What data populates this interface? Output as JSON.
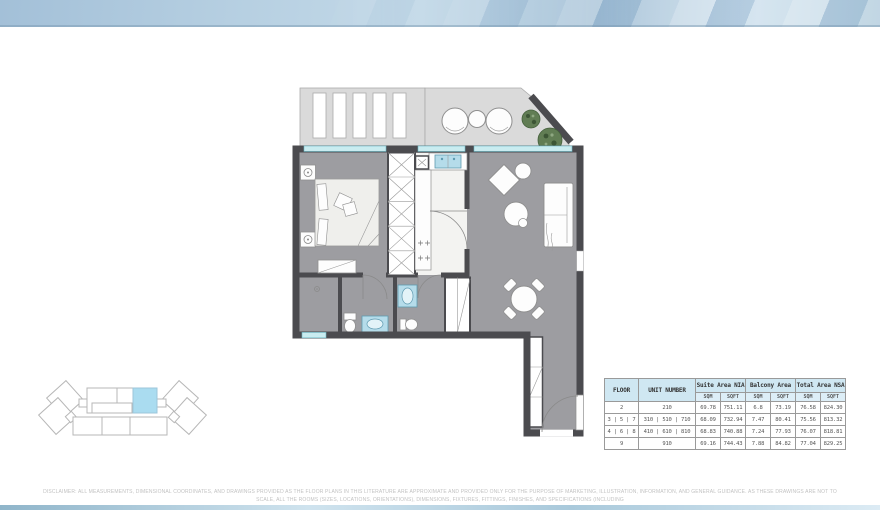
{
  "colors": {
    "wall": "#4b4b4f",
    "floor": "#9d9da1",
    "kitchen_floor": "#f3f3f1",
    "terrace": "#dadada",
    "window": "#c9ecf0",
    "window_edge": "#6ebac6",
    "fixture": "#b5dcea",
    "furniture": "#fdfdfd",
    "outline": "#8f8f8f",
    "plant": "#617d54",
    "table_header_bg": "#cfe7f2",
    "table_subheader_bg": "#ddeef7",
    "table_border": "#9a9a9a",
    "keyplan_line": "#b7b7b7",
    "keyplan_highlight": "#aadcf0"
  },
  "table": {
    "headers": {
      "floor": "FLOOR",
      "unit": "UNIT NUMBER",
      "suite": "Suite Area NIA",
      "balcony": "Balcony Area",
      "total": "Total Area NSA",
      "sqm": "SQM",
      "sqft": "SQFT"
    },
    "rows": [
      {
        "floor": "2",
        "unit": "210",
        "suite_sqm": "69.78",
        "suite_sqft": "751.11",
        "balcony_sqm": "6.8",
        "balcony_sqft": "73.19",
        "total_sqm": "76.58",
        "total_sqft": "824.30"
      },
      {
        "floor": "3 | 5 | 7",
        "unit": "310 | 510 | 710",
        "suite_sqm": "68.09",
        "suite_sqft": "732.94",
        "balcony_sqm": "7.47",
        "balcony_sqft": "80.41",
        "total_sqm": "75.56",
        "total_sqft": "813.32"
      },
      {
        "floor": "4 | 6 | 8",
        "unit": "410 | 610 | 810",
        "suite_sqm": "68.83",
        "suite_sqft": "740.88",
        "balcony_sqm": "7.24",
        "balcony_sqft": "77.93",
        "total_sqm": "76.07",
        "total_sqft": "818.81"
      },
      {
        "floor": "9",
        "unit": "910",
        "suite_sqm": "69.16",
        "suite_sqft": "744.43",
        "balcony_sqm": "7.88",
        "balcony_sqft": "84.82",
        "total_sqm": "77.04",
        "total_sqft": "829.25"
      }
    ]
  },
  "disclaimer": {
    "line1": "DISCLAIMER: ALL MEASUREMENTS, DIMENSIONAL COORDINATES, AND DRAWINGS PROVIDED AS THE FLOOR PLANS IN THIS LITERATURE ARE APPROXIMATE AND PROVIDED ONLY FOR THE PURPOSE OF MARKETING, ILLUSTRATION, INFORMATION, AND GENERAL GUIDANCE. AS THESE DRAWINGS ARE NOT TO SCALE, ALL THE ROOMS (SIZES, LOCATIONS, ORIENTATIONS), DIMENSIONS, FIXTURES, FITTINGS, FINISHES, AND SPECIFICATIONS (INCLUDING",
    "line2": "MATERIALS) ARE SUBJECT TO CHANGE WITHOUT NOTICE AND MAY VARY FROM THE FINAL CONSTRUCTED UNIT. PURCHASERS ARE ADVISED TO VERIFY ALL DETAILS AND SPECIFICATIONS WITH THE DEVELOPER PRIOR TO PURCHASE."
  }
}
